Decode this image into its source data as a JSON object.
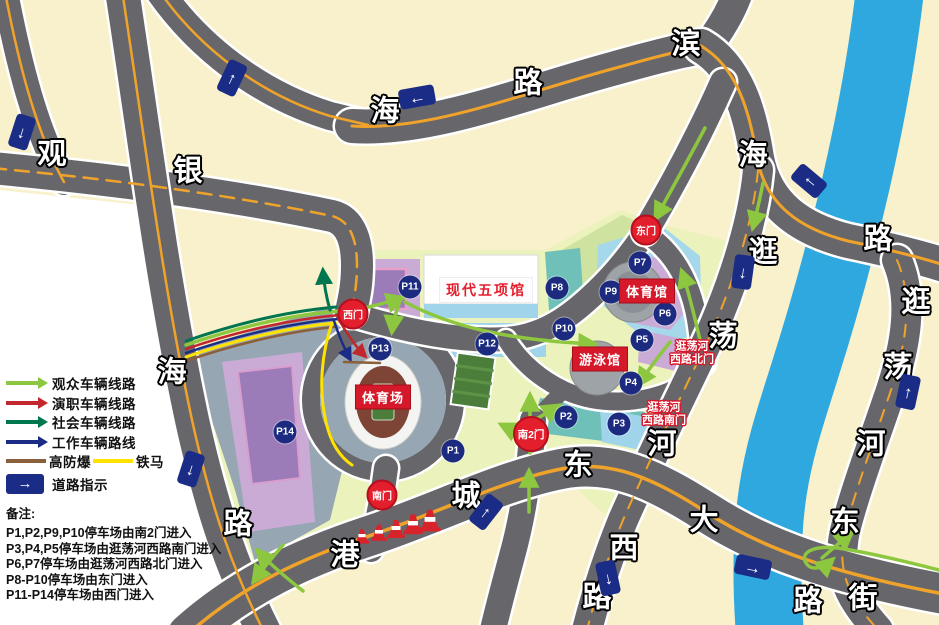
{
  "map": {
    "road_name_chars": [
      {
        "ch": "观",
        "x": 52,
        "y": 155
      },
      {
        "ch": "银",
        "x": 188,
        "y": 172
      },
      {
        "ch": "海",
        "x": 385,
        "y": 112
      },
      {
        "ch": "路",
        "x": 528,
        "y": 84
      },
      {
        "ch": "滨",
        "x": 686,
        "y": 45
      },
      {
        "ch": "海",
        "x": 753,
        "y": 156
      },
      {
        "ch": "路",
        "x": 878,
        "y": 240
      },
      {
        "ch": "海",
        "x": 172,
        "y": 373
      },
      {
        "ch": "路",
        "x": 238,
        "y": 525
      },
      {
        "ch": "港",
        "x": 345,
        "y": 556
      },
      {
        "ch": "城",
        "x": 466,
        "y": 497
      },
      {
        "ch": "东",
        "x": 578,
        "y": 466
      },
      {
        "ch": "大",
        "x": 704,
        "y": 521
      },
      {
        "ch": "西",
        "x": 624,
        "y": 549
      },
      {
        "ch": "路",
        "x": 597,
        "y": 598
      },
      {
        "ch": "逛",
        "x": 763,
        "y": 253
      },
      {
        "ch": "荡",
        "x": 723,
        "y": 337
      },
      {
        "ch": "河",
        "x": 662,
        "y": 445
      },
      {
        "ch": "逛",
        "x": 916,
        "y": 303
      },
      {
        "ch": "荡",
        "x": 898,
        "y": 368
      },
      {
        "ch": "河",
        "x": 871,
        "y": 445
      },
      {
        "ch": "东",
        "x": 845,
        "y": 523
      },
      {
        "ch": "街",
        "x": 863,
        "y": 599
      },
      {
        "ch": "路",
        "x": 808,
        "y": 602
      }
    ],
    "direction_signs": [
      {
        "glyph": "↓",
        "x": 22,
        "y": 132,
        "rotate": 18
      },
      {
        "glyph": "↑",
        "x": 232,
        "y": 78,
        "rotate": 25
      },
      {
        "glyph": "←",
        "x": 417,
        "y": 97,
        "rotate": -10,
        "cls": "landscape"
      },
      {
        "glyph": "↑",
        "x": 809,
        "y": 181,
        "rotate": -50
      },
      {
        "glyph": "↓",
        "x": 743,
        "y": 272,
        "rotate": 8
      },
      {
        "glyph": "↑",
        "x": 908,
        "y": 392,
        "rotate": 12
      },
      {
        "glyph": "↓",
        "x": 191,
        "y": 469,
        "rotate": 18
      },
      {
        "glyph": "↑",
        "x": 486,
        "y": 512,
        "rotate": 38
      },
      {
        "glyph": "↓",
        "x": 608,
        "y": 578,
        "rotate": -12
      },
      {
        "glyph": "→",
        "x": 753,
        "y": 567,
        "rotate": 12,
        "cls": "landscape"
      }
    ],
    "parking_markers": [
      {
        "label": "P1",
        "x": 453,
        "y": 451
      },
      {
        "label": "P2",
        "x": 566,
        "y": 417
      },
      {
        "label": "P3",
        "x": 619,
        "y": 424
      },
      {
        "label": "P4",
        "x": 631,
        "y": 383
      },
      {
        "label": "P5",
        "x": 642,
        "y": 340
      },
      {
        "label": "P6",
        "x": 665,
        "y": 314
      },
      {
        "label": "P7",
        "x": 640,
        "y": 263
      },
      {
        "label": "P8",
        "x": 557,
        "y": 288
      },
      {
        "label": "P9",
        "x": 611,
        "y": 292
      },
      {
        "label": "P10",
        "x": 564,
        "y": 329
      },
      {
        "label": "P11",
        "x": 410,
        "y": 287
      },
      {
        "label": "P12",
        "x": 487,
        "y": 344
      },
      {
        "label": "P13",
        "x": 380,
        "y": 349
      },
      {
        "label": "P14",
        "x": 285,
        "y": 432
      }
    ],
    "gates": [
      {
        "label": "西门",
        "x": 353,
        "y": 314
      },
      {
        "label": "东门",
        "x": 646,
        "y": 230
      },
      {
        "label": "南门",
        "x": 382,
        "y": 495
      },
      {
        "label": "南2门",
        "x": 531,
        "y": 434,
        "cls": "big"
      }
    ],
    "venue_labels": [
      {
        "label": "体育场",
        "x": 383,
        "y": 397
      },
      {
        "label": "体育馆",
        "x": 647,
        "y": 291
      },
      {
        "label": "游泳馆",
        "x": 600,
        "y": 359
      },
      {
        "label": "现代五项馆",
        "x": 486,
        "y": 290,
        "cls": "inverse"
      }
    ],
    "gate_entry_labels": [
      {
        "line1": "逛荡河",
        "line2": "西路北门",
        "x": 692,
        "y": 353
      },
      {
        "line1": "逛荡河",
        "line2": "西路南门",
        "x": 664,
        "y": 414
      }
    ]
  },
  "legend": {
    "routes": [
      {
        "label": "观众车辆线路",
        "color": "#8DC63F"
      },
      {
        "label": "演职车辆线路",
        "color": "#C1272D"
      },
      {
        "label": "社会车辆线路",
        "color": "#00764E"
      },
      {
        "label": "工作车辆路线",
        "color": "#1B2C86"
      }
    ],
    "barriers": [
      {
        "label": "高防爆",
        "color": "#8A5F3C"
      },
      {
        "label": "铁马",
        "color": "#FFE200"
      }
    ],
    "sign_glyph": "→",
    "sign_label": "道路指示",
    "notes_title": "备注:",
    "notes": [
      {
        "text": "P1,P2,P9,P10停车场由南2门进入"
      },
      {
        "text": "P3,P4,P5停车场由逛荡河西路南门进入"
      },
      {
        "text": "P6,P7停车场由逛荡河西路北门进入"
      },
      {
        "text": "P8-P10停车场由东门进入"
      },
      {
        "text": "P11-P14停车场由西门进入"
      }
    ]
  },
  "colors": {
    "land": "#F8F1CC",
    "road": "#67676B",
    "river": "#2FA8E0",
    "plaza": "#97A6B3",
    "lavender": "#C9ABD6",
    "light_blue": "#A5D8EA",
    "teal": "#6FC0B8",
    "pale_green": "#ECF2BC",
    "marker_navy": "#1C2B7F",
    "gate_red": "#E31E2D",
    "label_red": "#D6182B",
    "orange_line": "#F0A32A"
  }
}
